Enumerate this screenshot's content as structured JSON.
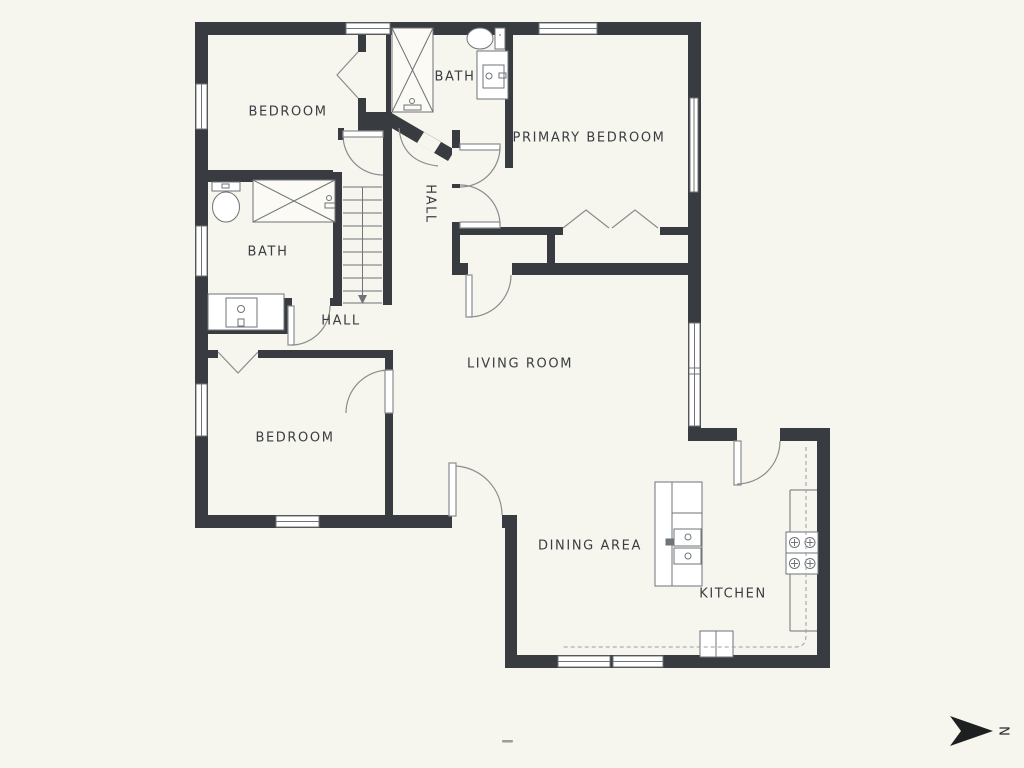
{
  "title": "Floor plan",
  "rooms": [
    {
      "id": "bedroom-1",
      "label": "BEDROOM"
    },
    {
      "id": "bath-1",
      "label": "BATH"
    },
    {
      "id": "primary-bedroom",
      "label": "PRIMARY BEDROOM"
    },
    {
      "id": "hall-upper",
      "label": "HALL"
    },
    {
      "id": "bath-2",
      "label": "BATH"
    },
    {
      "id": "hall-lower",
      "label": "HALL"
    },
    {
      "id": "living-room",
      "label": "LIVING ROOM"
    },
    {
      "id": "bedroom-2",
      "label": "BEDROOM"
    },
    {
      "id": "dining-area",
      "label": "DINING AREA"
    },
    {
      "id": "kitchen",
      "label": "KITCHEN"
    }
  ],
  "compass": {
    "letter": "N",
    "direction": "right"
  },
  "fixtures": [
    "shower-tub",
    "toilet",
    "vanity-sink",
    "bathtub",
    "toilet",
    "vanity-sink",
    "stairs-down",
    "kitchen-island-with-sink",
    "range-stove",
    "kitchen-counter",
    "upper-cabinets-dashed"
  ],
  "doors": [
    "bedroom-1-door",
    "bath-1-door",
    "hall-to-primary-door-upper",
    "hall-to-primary-door-lower",
    "stair-hall-door",
    "bath-2-door",
    "bedroom-2-door",
    "living-room-closet-door",
    "front-entry-door",
    "kitchen-door"
  ],
  "colors": {
    "background": "#f6f5ee",
    "wall": "#383c40",
    "fixture-line": "#6f7478",
    "door-line": "#8a8d8f",
    "label-text": "#3a3e42"
  }
}
